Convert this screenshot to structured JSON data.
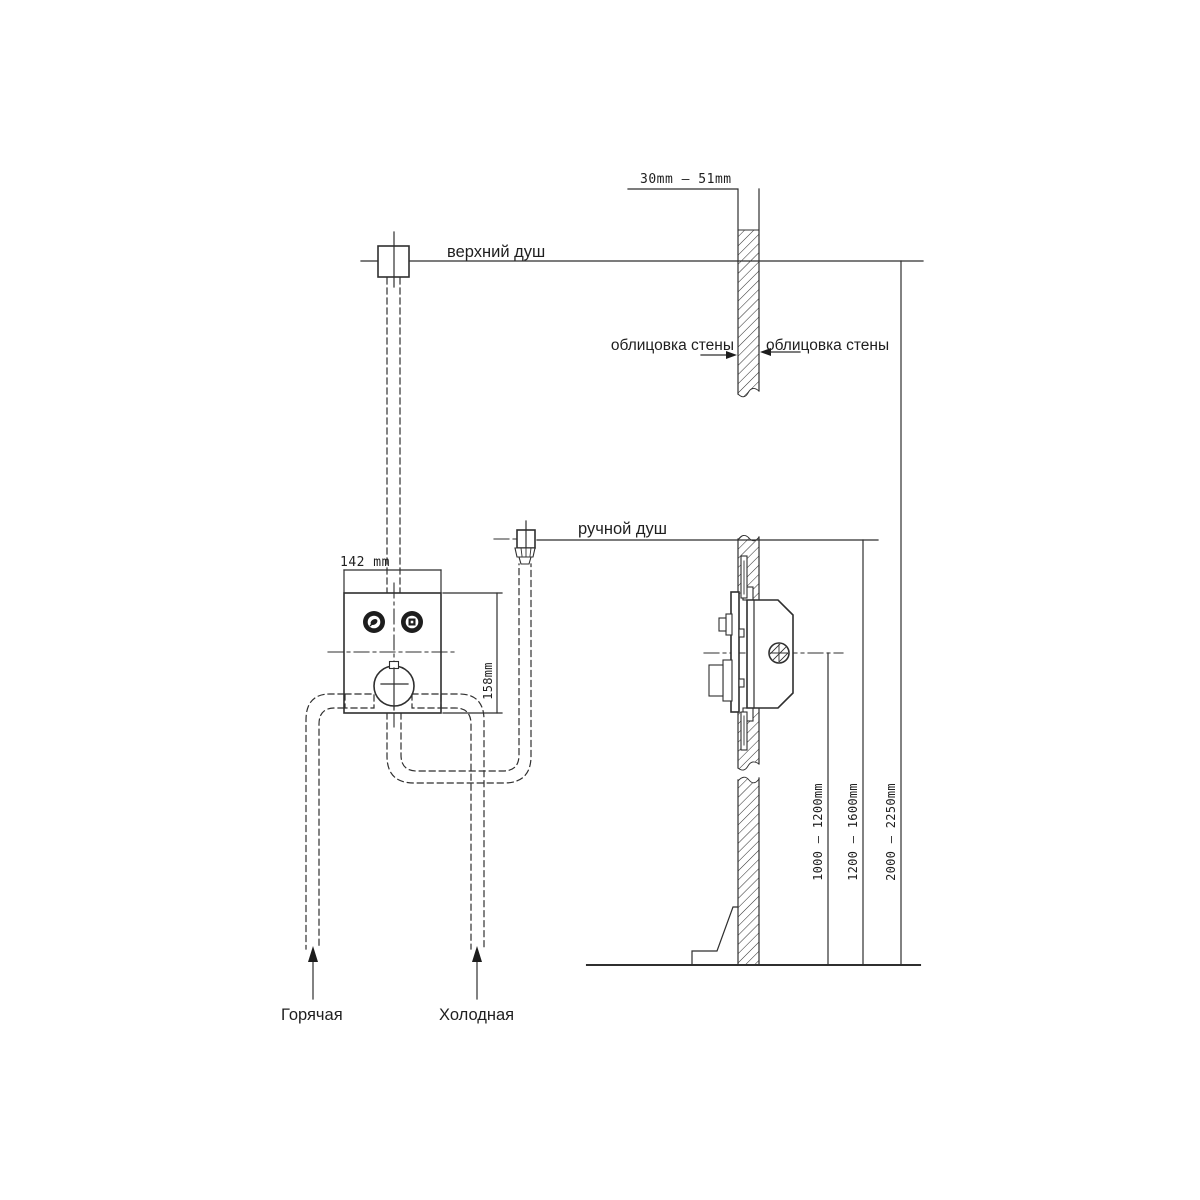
{
  "meta": {
    "drawing_type": "concealed shower mixer installation diagram",
    "background_color": "#ffffff",
    "line_color": "#2f2f2f"
  },
  "labels": {
    "overhead_shower": "верхний душ",
    "hand_shower": "ручной душ",
    "wall_cladding_left": "облицовка стены",
    "wall_cladding_right": "облицовка стены",
    "hot_water": "Горячая",
    "cold_water": "Холодная"
  },
  "dimensions": {
    "wall_thickness": "30mm – 51mm",
    "valve_width": "142 mm",
    "valve_height": "158mm",
    "valve_axis_height": "1000 – 1200mm",
    "hand_shower_height": "1200 – 1600mm",
    "overhead_shower_height": "2000 – 2250mm"
  }
}
